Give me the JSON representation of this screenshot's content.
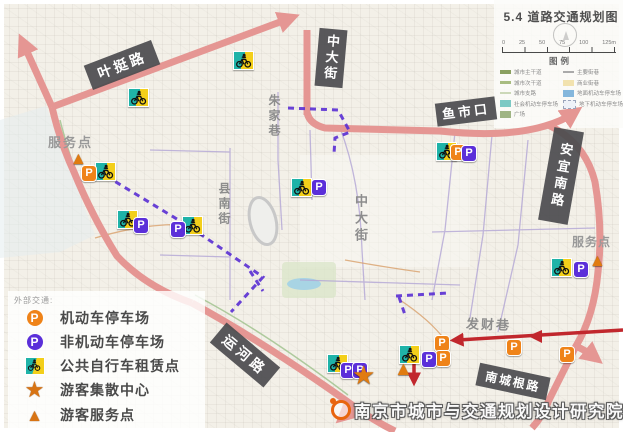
{
  "page": {
    "title": "5.4 道路交通规划图"
  },
  "scalebar": {
    "ticks": [
      "0",
      "25",
      "50",
      "75",
      "100",
      "125m"
    ]
  },
  "legend": {
    "title": "图例",
    "left": [
      {
        "label": "城市主干道"
      },
      {
        "label": "城市次干道"
      },
      {
        "label": "城市支路"
      },
      {
        "label": "社会机动车停车场"
      },
      {
        "label": "广场"
      }
    ],
    "right": [
      {
        "label": "主要街巷"
      },
      {
        "label": "商业街巷"
      },
      {
        "label": "地面机动车停车场"
      },
      {
        "label": "地下机动车停车场"
      }
    ]
  },
  "transport_legend": {
    "title": "外部交通:",
    "items": [
      {
        "icon": "motor-parking",
        "label": "机动车停车场"
      },
      {
        "icon": "nonmotor-parking",
        "label": "非机动车停车场"
      },
      {
        "icon": "bike-rental",
        "label": "公共自行车租赁点"
      },
      {
        "icon": "visitor-center",
        "label": "游客集散中心"
      },
      {
        "icon": "visitor-service",
        "label": "游客服务点"
      }
    ]
  },
  "map": {
    "road_labels": {
      "yeting": "叶挺路",
      "zhongda_top": "中大街",
      "yushikou": "鱼市口",
      "anyi": "安宜南路",
      "yunhe": "运河路",
      "chenggen": "南城根路"
    },
    "street_labels": {
      "zhujia": "朱家巷",
      "xiannan": "县南街",
      "zhongda_mid": "中大街",
      "facai": "发财巷"
    },
    "poi_labels": {
      "service_left": "服务点",
      "service_right": "服务点"
    }
  },
  "icons": {
    "motor_parking": {
      "glyph": "P"
    },
    "nonmotor_parking": {
      "glyph": "P"
    },
    "visitor_center": {
      "glyph": "★"
    },
    "visitor_service": {
      "glyph": "▲"
    }
  },
  "footer": {
    "institute": "南京市城市与交通规划设计研究院"
  },
  "colors": {
    "arterial_road": "#e59693",
    "tour_route": "#c1272d",
    "pedestrian_route": "#5a2fd4",
    "motor_parking": "#ef8318",
    "nonmotor_parking": "#5b2fd9",
    "bike_teal": "#1fb3a8",
    "bike_yellow": "#f3cf1a"
  }
}
